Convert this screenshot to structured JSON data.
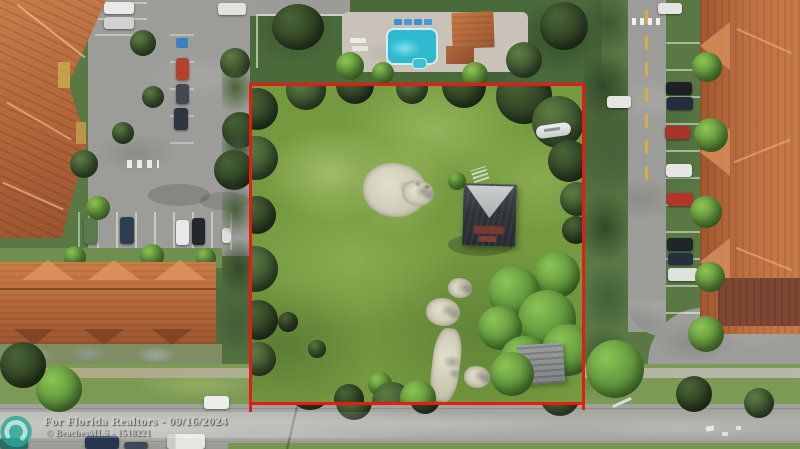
{
  "image": {
    "type": "aerial-drone-photo",
    "subject": "Vacant grassy residential lot outlined in red between townhome communities",
    "width_px": 800,
    "height_px": 449
  },
  "watermark": {
    "line1": "For Florida Realtors - 09/16/2024",
    "line2": "© BeachesMLS - 1518221",
    "logo_name": "beachesmls-swirl-logo"
  },
  "annotation": {
    "boundary_shape": "rectangle",
    "boundary_color": "#e51b16"
  },
  "palette": {
    "lot_grass": "#74993f",
    "trees_dark": "#33482a",
    "trees_bright": "#6cae39",
    "road_gray": "#a6a6a2",
    "roof_terracotta": "#b5683c",
    "pool_water": "#3fc6d8",
    "sand_patch": "#d6d3bf",
    "house_roof_dark": "#2f3438",
    "house_roof_light": "#c4c9c9",
    "watermark_text": "#cbcbc9",
    "watermark_logo_teal": "#2ba897"
  }
}
